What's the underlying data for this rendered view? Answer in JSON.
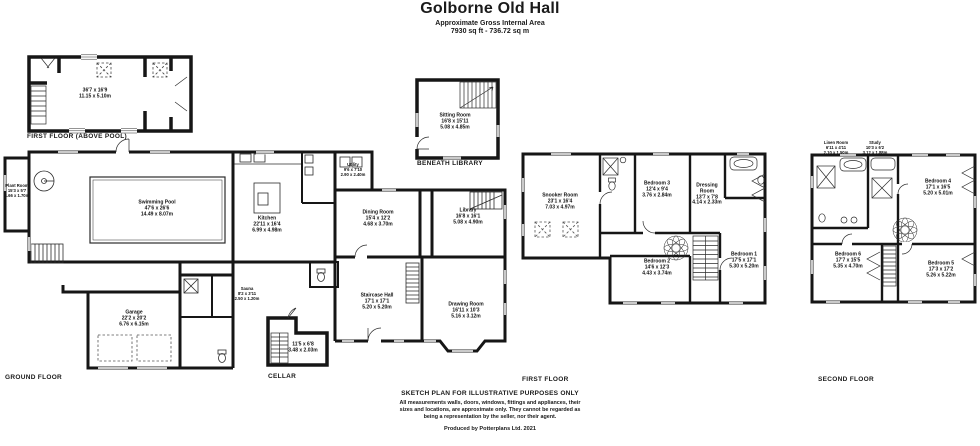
{
  "header": {
    "title": "Golborne Old Hall",
    "subtitle": "Approximate Gross Internal Area",
    "area": "7930 sq ft - 736.72 sq m"
  },
  "floors": {
    "above_pool": {
      "caption": "FIRST FLOOR (ABOVE POOL)",
      "room": {
        "ft": "36'7 x 16'9",
        "m": "11.15 x 5.10m"
      }
    },
    "ground": {
      "caption": "GROUND FLOOR",
      "rooms": {
        "plant": {
          "name": "Plant Room",
          "ft": "15'3 x 5'7",
          "m": "4.66 x 1.70m"
        },
        "pool": {
          "name": "Swimming Pool",
          "ft": "47'6 x 26'6",
          "m": "14.49 x 8.07m"
        },
        "kitchen": {
          "name": "Kitchen",
          "ft": "22'11 x 16'4",
          "m": "6.99 x 4.98m"
        },
        "utility": {
          "name": "Utility",
          "ft": "9'6 x 7'10",
          "m": "2.90 x 2.40m"
        },
        "dining": {
          "name": "Dining Room",
          "ft": "15'4 x 12'2",
          "m": "4.68 x 3.70m"
        },
        "library": {
          "name": "Library",
          "ft": "16'8 x 16'1",
          "m": "5.08 x 4.90m"
        },
        "sauna": {
          "name": "Sauna",
          "ft": "8'2 x 3'11",
          "m": "2.50 x 1.20m"
        },
        "staircase_hall": {
          "name": "Staircase Hall",
          "ft": "17'1 x 17'1",
          "m": "5.20 x 5.20m"
        },
        "drawing": {
          "name": "Drawing Room",
          "ft": "16'11 x 10'3",
          "m": "5.16 x 3.12m"
        },
        "garage": {
          "name": "Garage",
          "ft": "22'2 x 20'2",
          "m": "6.76 x 6.15m"
        }
      }
    },
    "beneath_library": {
      "caption": "BENEATH LIBRARY",
      "room": {
        "name": "Sitting Room",
        "ft": "16'8 x 15'11",
        "m": "5.08 x 4.85m"
      }
    },
    "cellar": {
      "caption": "CELLAR",
      "room": {
        "ft": "11'5 x 6'8",
        "m": "3.48 x 2.03m"
      }
    },
    "first": {
      "caption": "FIRST FLOOR",
      "rooms": {
        "snooker": {
          "name": "Snooker Room",
          "ft": "23'1 x 16'4",
          "m": "7.03 x 4.97m"
        },
        "bed3": {
          "name": "Bedroom 3",
          "ft": "12'4 x 9'4",
          "m": "3.76 x 2.84m"
        },
        "dressing": {
          "name": "Dressing Room",
          "ft": "13'7 x 7'8",
          "m": "4.14 x 2.33m"
        },
        "bed1": {
          "name": "Bedroom 1",
          "ft": "17'5 x 17'1",
          "m": "5.30 x 5.20m"
        },
        "bed2": {
          "name": "Bedroom 2",
          "ft": "14'6 x 12'3",
          "m": "4.43 x 3.74m"
        }
      }
    },
    "second": {
      "caption": "SECOND FLOOR",
      "rooms": {
        "linen": {
          "name": "Linen Room",
          "ft": "6'11 x 4'11",
          "m": "2.10 x 1.50m"
        },
        "study": {
          "name": "Study",
          "ft": "10'3 x 6'2",
          "m": "3.12 x 1.88m"
        },
        "bed4": {
          "name": "Bedroom 4",
          "ft": "17'1 x 16'5",
          "m": "5.20 x 5.01m"
        },
        "bed6": {
          "name": "Bedroom 6",
          "ft": "17'7 x 15'5",
          "m": "5.35 x 4.70m"
        },
        "bed5": {
          "name": "Bedroom 5",
          "ft": "17'3 x 17'2",
          "m": "5.26 x 5.22m"
        }
      }
    }
  },
  "footer": {
    "disclaimer_title": "SKETCH PLAN FOR ILLUSTRATIVE PURPOSES ONLY",
    "line1": "All measurements walls, doors, windows, fittings and appliances, their",
    "line2": "sizes and locations, are approximate only. They cannot be regarded as",
    "line3": "being a representation by the seller, nor their agent.",
    "credit": "Produced by Potterplans Ltd. 2021"
  },
  "colors": {
    "wall": "#161616",
    "text": "#1a1a1a"
  }
}
